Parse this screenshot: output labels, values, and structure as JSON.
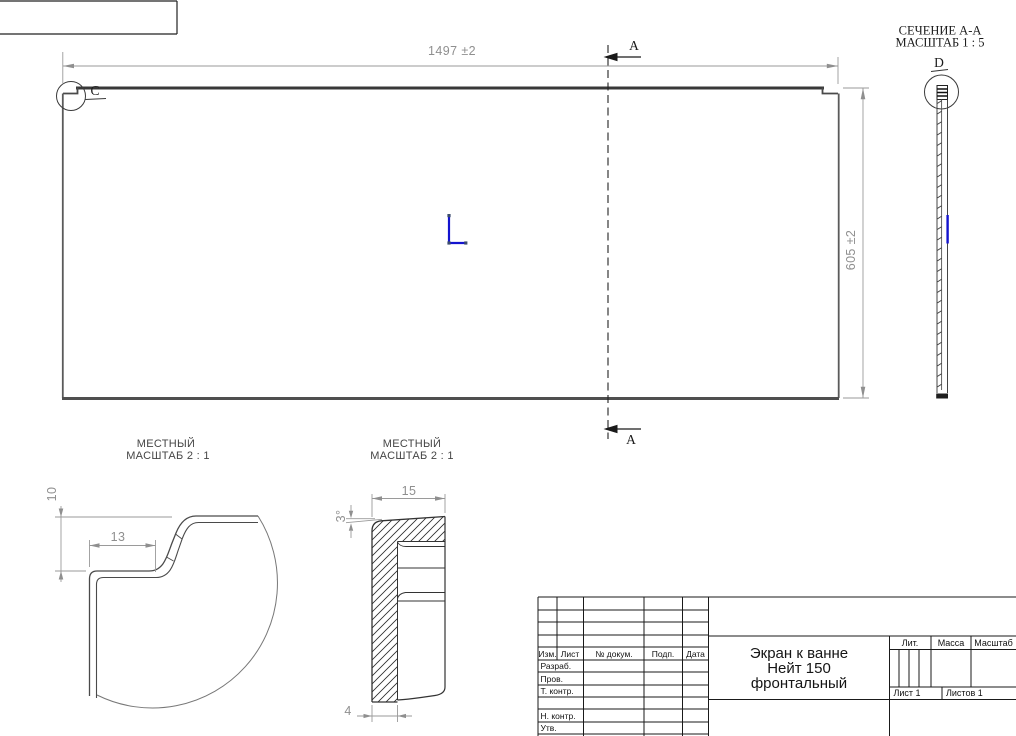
{
  "drawing": {
    "main_view": {
      "dim_width": "1497 ±2",
      "dim_height": "605 ±2",
      "section_label_top": "A",
      "section_label_bottom": "A",
      "detail_label": "C"
    },
    "section_view": {
      "title": "СЕЧЕНИЕ А-А",
      "scale": "МАСШТАБ 1 : 5",
      "detail_label": "D"
    },
    "detail_c": {
      "title": "МЕСТНЫЙ",
      "scale": "МАСШТАБ 2 : 1",
      "dim_height": "10",
      "dim_width": "13"
    },
    "detail_d": {
      "title": "МЕСТНЫЙ",
      "scale": "МАСШТАБ 2 : 1",
      "dim_width": "15",
      "dim_angle": "3°",
      "dim_thickness": "4"
    }
  },
  "title_block": {
    "name_line1": "Экран к ванне",
    "name_line2": "Нейт 150",
    "name_line3": "фронтальный",
    "columns": {
      "izm": "Изм.",
      "list": "Лист",
      "dokum": "№ докум.",
      "podp": "Подп.",
      "data": "Дата"
    },
    "rows": {
      "razrab": "Разраб.",
      "prov": "Пров.",
      "t_kontr": "Т. контр.",
      "n_kontr": "Н. контр.",
      "utv": "Утв."
    },
    "lit": "Лит.",
    "massa": "Масса",
    "masshtab": "Масштаб",
    "list_num": "Лист 1",
    "listov_num": "Листов 1"
  },
  "colors": {
    "selection_blue": "#1414cf",
    "dim_gray": "#8f8f8f",
    "line_dark": "#3a3a3a"
  }
}
